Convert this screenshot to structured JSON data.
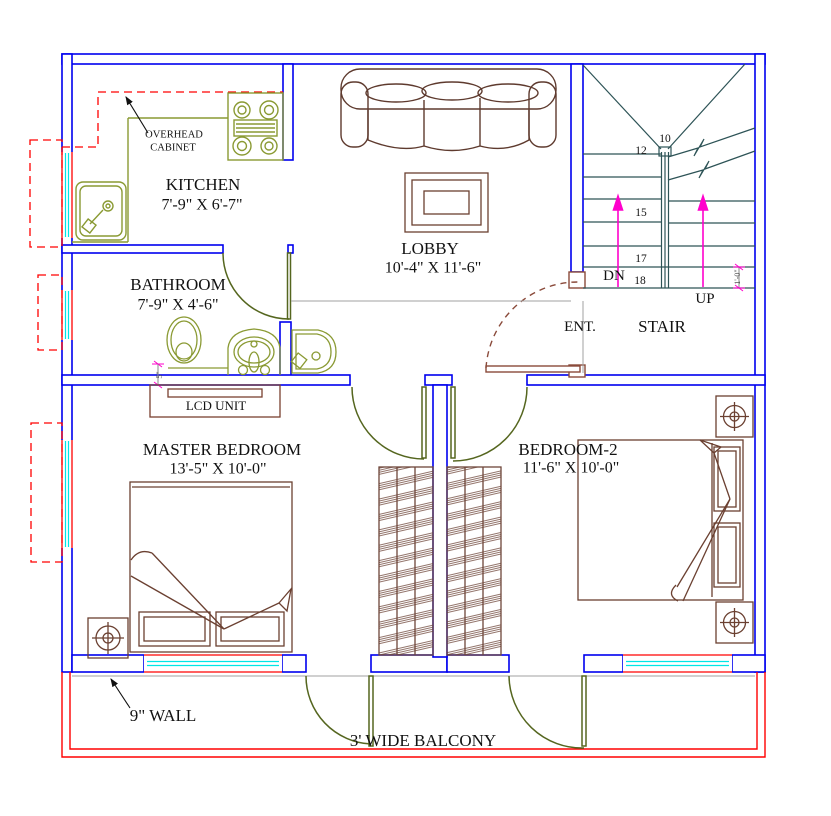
{
  "plan": {
    "rooms": {
      "kitchen": {
        "name": "KITCHEN",
        "dims": "7'-9\" X 6'-7\""
      },
      "bathroom": {
        "name": "BATHROOM",
        "dims": "7'-9\" X 4'-6\""
      },
      "lobby": {
        "name": "LOBBY",
        "dims": "10'-4\" X 11'-6\""
      },
      "master_bedroom": {
        "name": "MASTER BEDROOM",
        "dims": "13'-5\" X 10'-0\""
      },
      "bedroom2": {
        "name": "BEDROOM-2",
        "dims": "11'-6\" X 10'-0\""
      },
      "entrance": {
        "name": "ENT."
      },
      "stair": {
        "name": "STAIR"
      }
    },
    "annotations": {
      "overhead_line1": "OVERHEAD",
      "overhead_line2": "CABINET",
      "lcd_unit": "LCD UNIT",
      "wall_note": "9\" WALL",
      "balcony_note": "3' WIDE BALCONY",
      "down_label": "DN",
      "up_label": "UP",
      "stair_dim": "1'-0\"",
      "bath_dim": "5\""
    },
    "stair_numbers": {
      "n10": "10",
      "n12": "12",
      "n15": "15",
      "n17": "17",
      "n18": "18"
    },
    "colors": {
      "wall": "#0000ee",
      "balcony": "#ff0000",
      "window_glass": "#00e5e5",
      "fixture_olive": "#8a9a33",
      "door_olive": "#55661f",
      "furniture_brown": "#6b4031",
      "stair_line": "#2d5356",
      "arrow_magenta": "#ff00cc",
      "floor_gray": "#9a9a9a",
      "text": "#121212"
    }
  }
}
